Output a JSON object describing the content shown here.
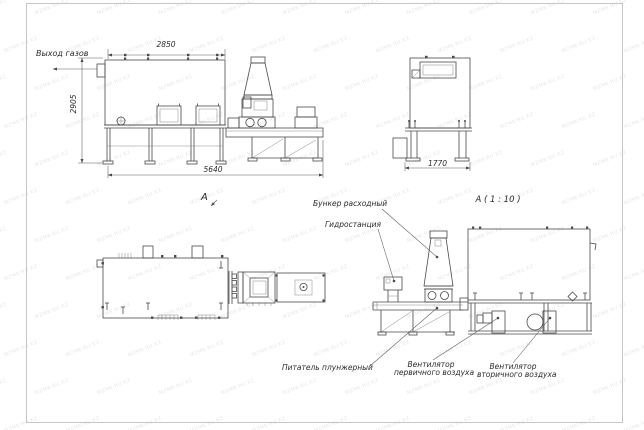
{
  "watermark": {
    "text": "MZMK-RU.KZ"
  },
  "labels": {
    "gas_outlet": "Выход газов",
    "view_a": "А",
    "section_title": "А ( 1 : 10 )",
    "hopper": "Бункер расходный",
    "hydro": "Гидростанция",
    "feeder": "Питатель плунжерный",
    "fan_primary_line1": "Вентилятор",
    "fan_primary_line2": "первичного воздуха",
    "fan_secondary_line1": "Вентилятор",
    "fan_secondary_line2": "вторичного воздуха"
  },
  "dimensions": {
    "front_top_width": "2850",
    "front_total_width": "5640",
    "front_height": "2905",
    "side_width": "1770"
  },
  "drawing_colors": {
    "object_line": "#4a4a4a",
    "dimension_line": "#5a5a5a",
    "sheet_frame": "#c6c6c6",
    "watermark": "rgba(40,40,70,0.12)"
  }
}
